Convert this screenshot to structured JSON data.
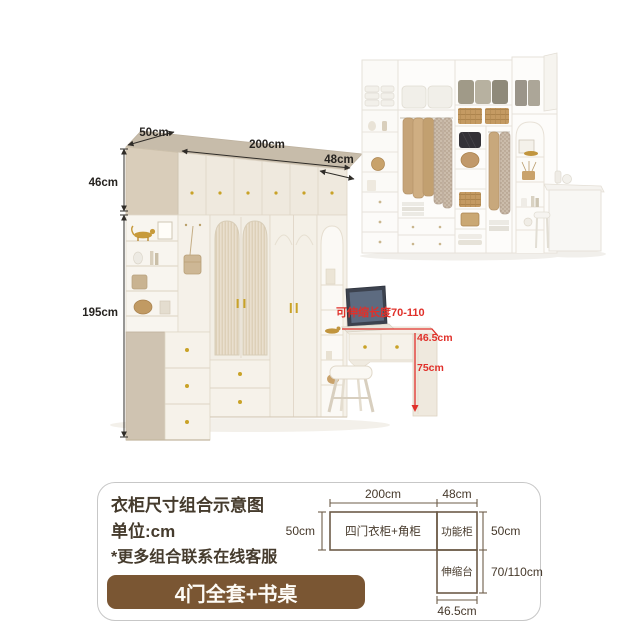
{
  "illustration": {
    "dim_depth": "50cm",
    "dim_width": "200cm",
    "dim_func_width": "48cm",
    "dim_top_height": "46cm",
    "dim_body_height": "195cm",
    "note_extendable": "可伸缩长度70-110",
    "dim_desk_depth": "46.5cm",
    "dim_desk_height": "75cm"
  },
  "info_panel": {
    "title": "衣柜尺寸组合示意图",
    "unit_line": "单位:cm",
    "note_line": "*更多组合联系在线客服",
    "button_label": "4门全套+书桌"
  },
  "floor_plan": {
    "dim_main_width": "200cm",
    "dim_func_width": "48cm",
    "dim_left_depth": "50cm",
    "dim_right_depth": "50cm",
    "dim_ext_range": "70/110cm",
    "dim_ext_width": "46.5cm",
    "label_main": "四门衣柜+角柜",
    "label_func": "功能柜",
    "label_ext": "伸缩台"
  },
  "colors": {
    "accent_red": "#e0302a",
    "button_brown": "#7a5633",
    "cabinet_beige": "#cfc3b1",
    "plan_line_brown": "#6d5c49"
  }
}
